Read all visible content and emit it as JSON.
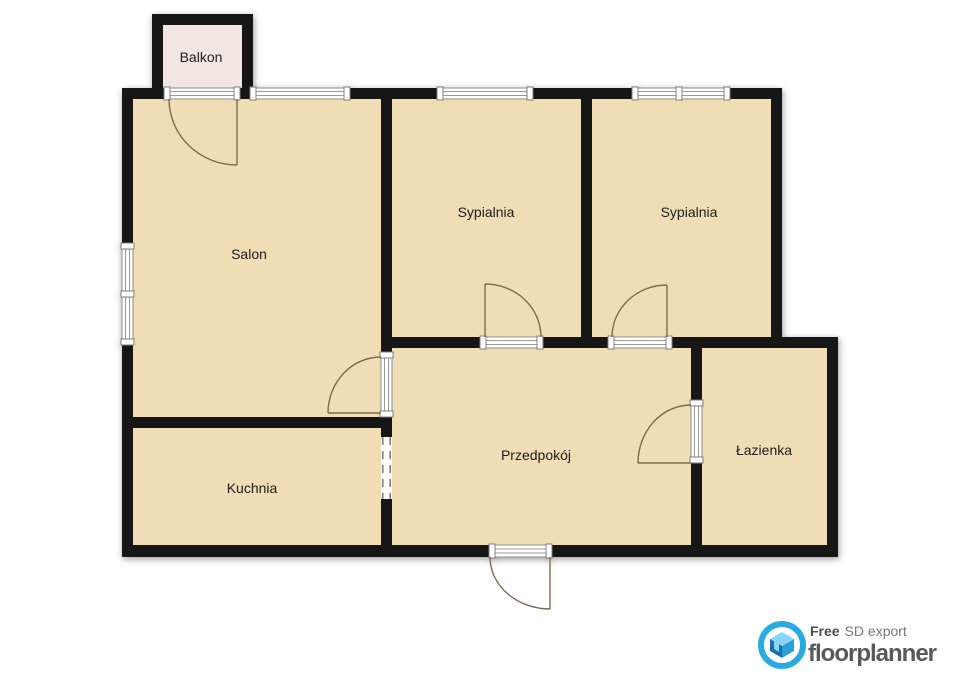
{
  "plan": {
    "rooms": [
      {
        "id": "balkon",
        "label": "Balkon"
      },
      {
        "id": "salon",
        "label": "Salon"
      },
      {
        "id": "sypialnia_1",
        "label": "Sypialnia"
      },
      {
        "id": "sypialnia_2",
        "label": "Sypialnia"
      },
      {
        "id": "kuchnia",
        "label": "Kuchnia"
      },
      {
        "id": "przedpokoj",
        "label": "Przedpokój"
      },
      {
        "id": "lazienka",
        "label": "Łazienka"
      }
    ],
    "colors": {
      "room_fill": "#f0dcb5",
      "balcony_fill": "#f3e6e1",
      "wall": "#141414",
      "door_arc": "#7d6b50",
      "frame_gray": "#8f8f8f"
    }
  },
  "branding": {
    "free_label": "Free",
    "export_label": "SD export",
    "brand_name": "floorplanner",
    "colors": {
      "ring_blue": "#29abe2",
      "house_dark_blue": "#1a6fb5",
      "house_mid_blue": "#2b9fd8",
      "house_light_blue": "#8ad5f4",
      "text_dark": "#4d4d4f",
      "text_gray": "#77787b",
      "brand_text": "#58595b"
    }
  }
}
